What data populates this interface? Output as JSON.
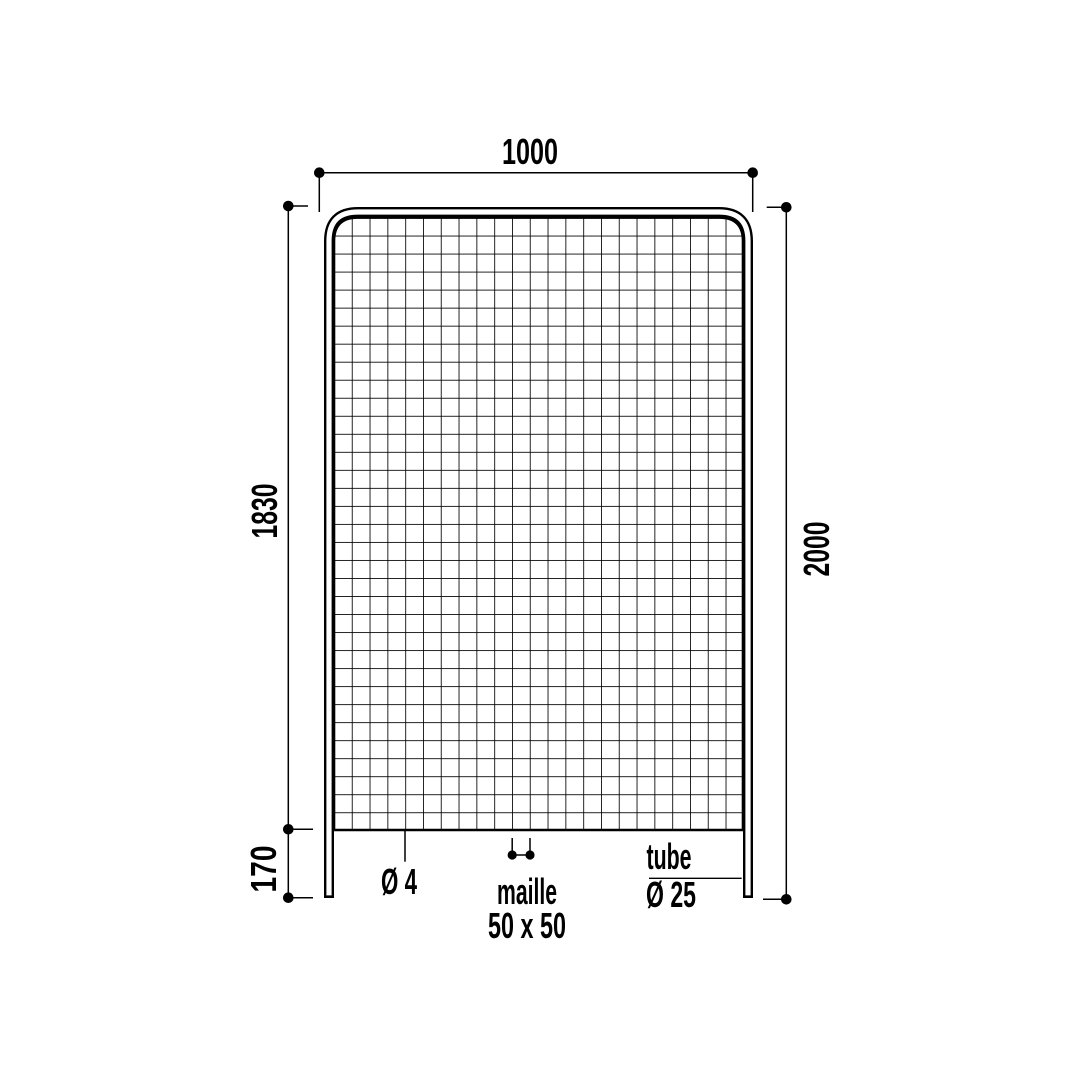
{
  "canvas": {
    "background": "#ffffff",
    "line_color": "#000000"
  },
  "dimensions": {
    "top_width": "1000",
    "mesh_height": "1830",
    "ground_clearance": "170",
    "total_height": "2000"
  },
  "labels": {
    "wire_diameter": "Ø 4",
    "mesh_name": "maille",
    "mesh_size": "50 x 50",
    "tube_name": "tube",
    "tube_diameter": "Ø 25"
  }
}
